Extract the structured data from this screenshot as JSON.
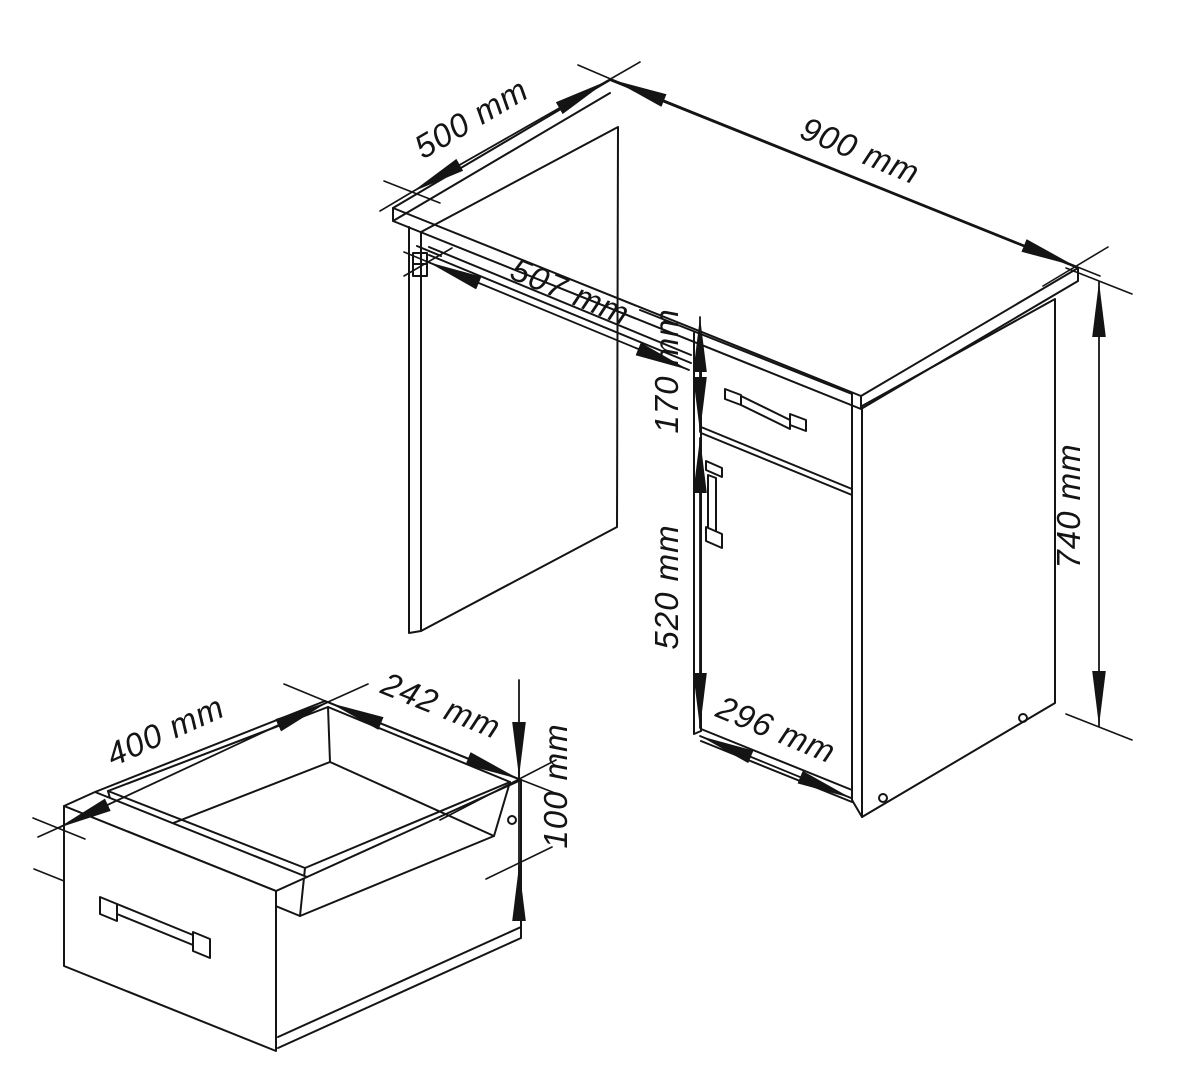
{
  "page": {
    "background": "#ffffff",
    "line_color": "#141414",
    "content": "technical dimension drawing of a desk with keyboard tray, drawer and cabinet door, plus a detail view of the pull-out drawer"
  },
  "desk": {
    "dim_depth": "500 mm",
    "dim_width": "900 mm",
    "dim_tray_width": "507 mm",
    "dim_drawer_front_height": "170 mm",
    "dim_door_height": "520 mm",
    "dim_total_height": "740 mm",
    "dim_cabinet_width": "296 mm"
  },
  "drawer": {
    "dim_depth": "400 mm",
    "dim_width": "242 mm",
    "dim_height": "100 mm"
  }
}
